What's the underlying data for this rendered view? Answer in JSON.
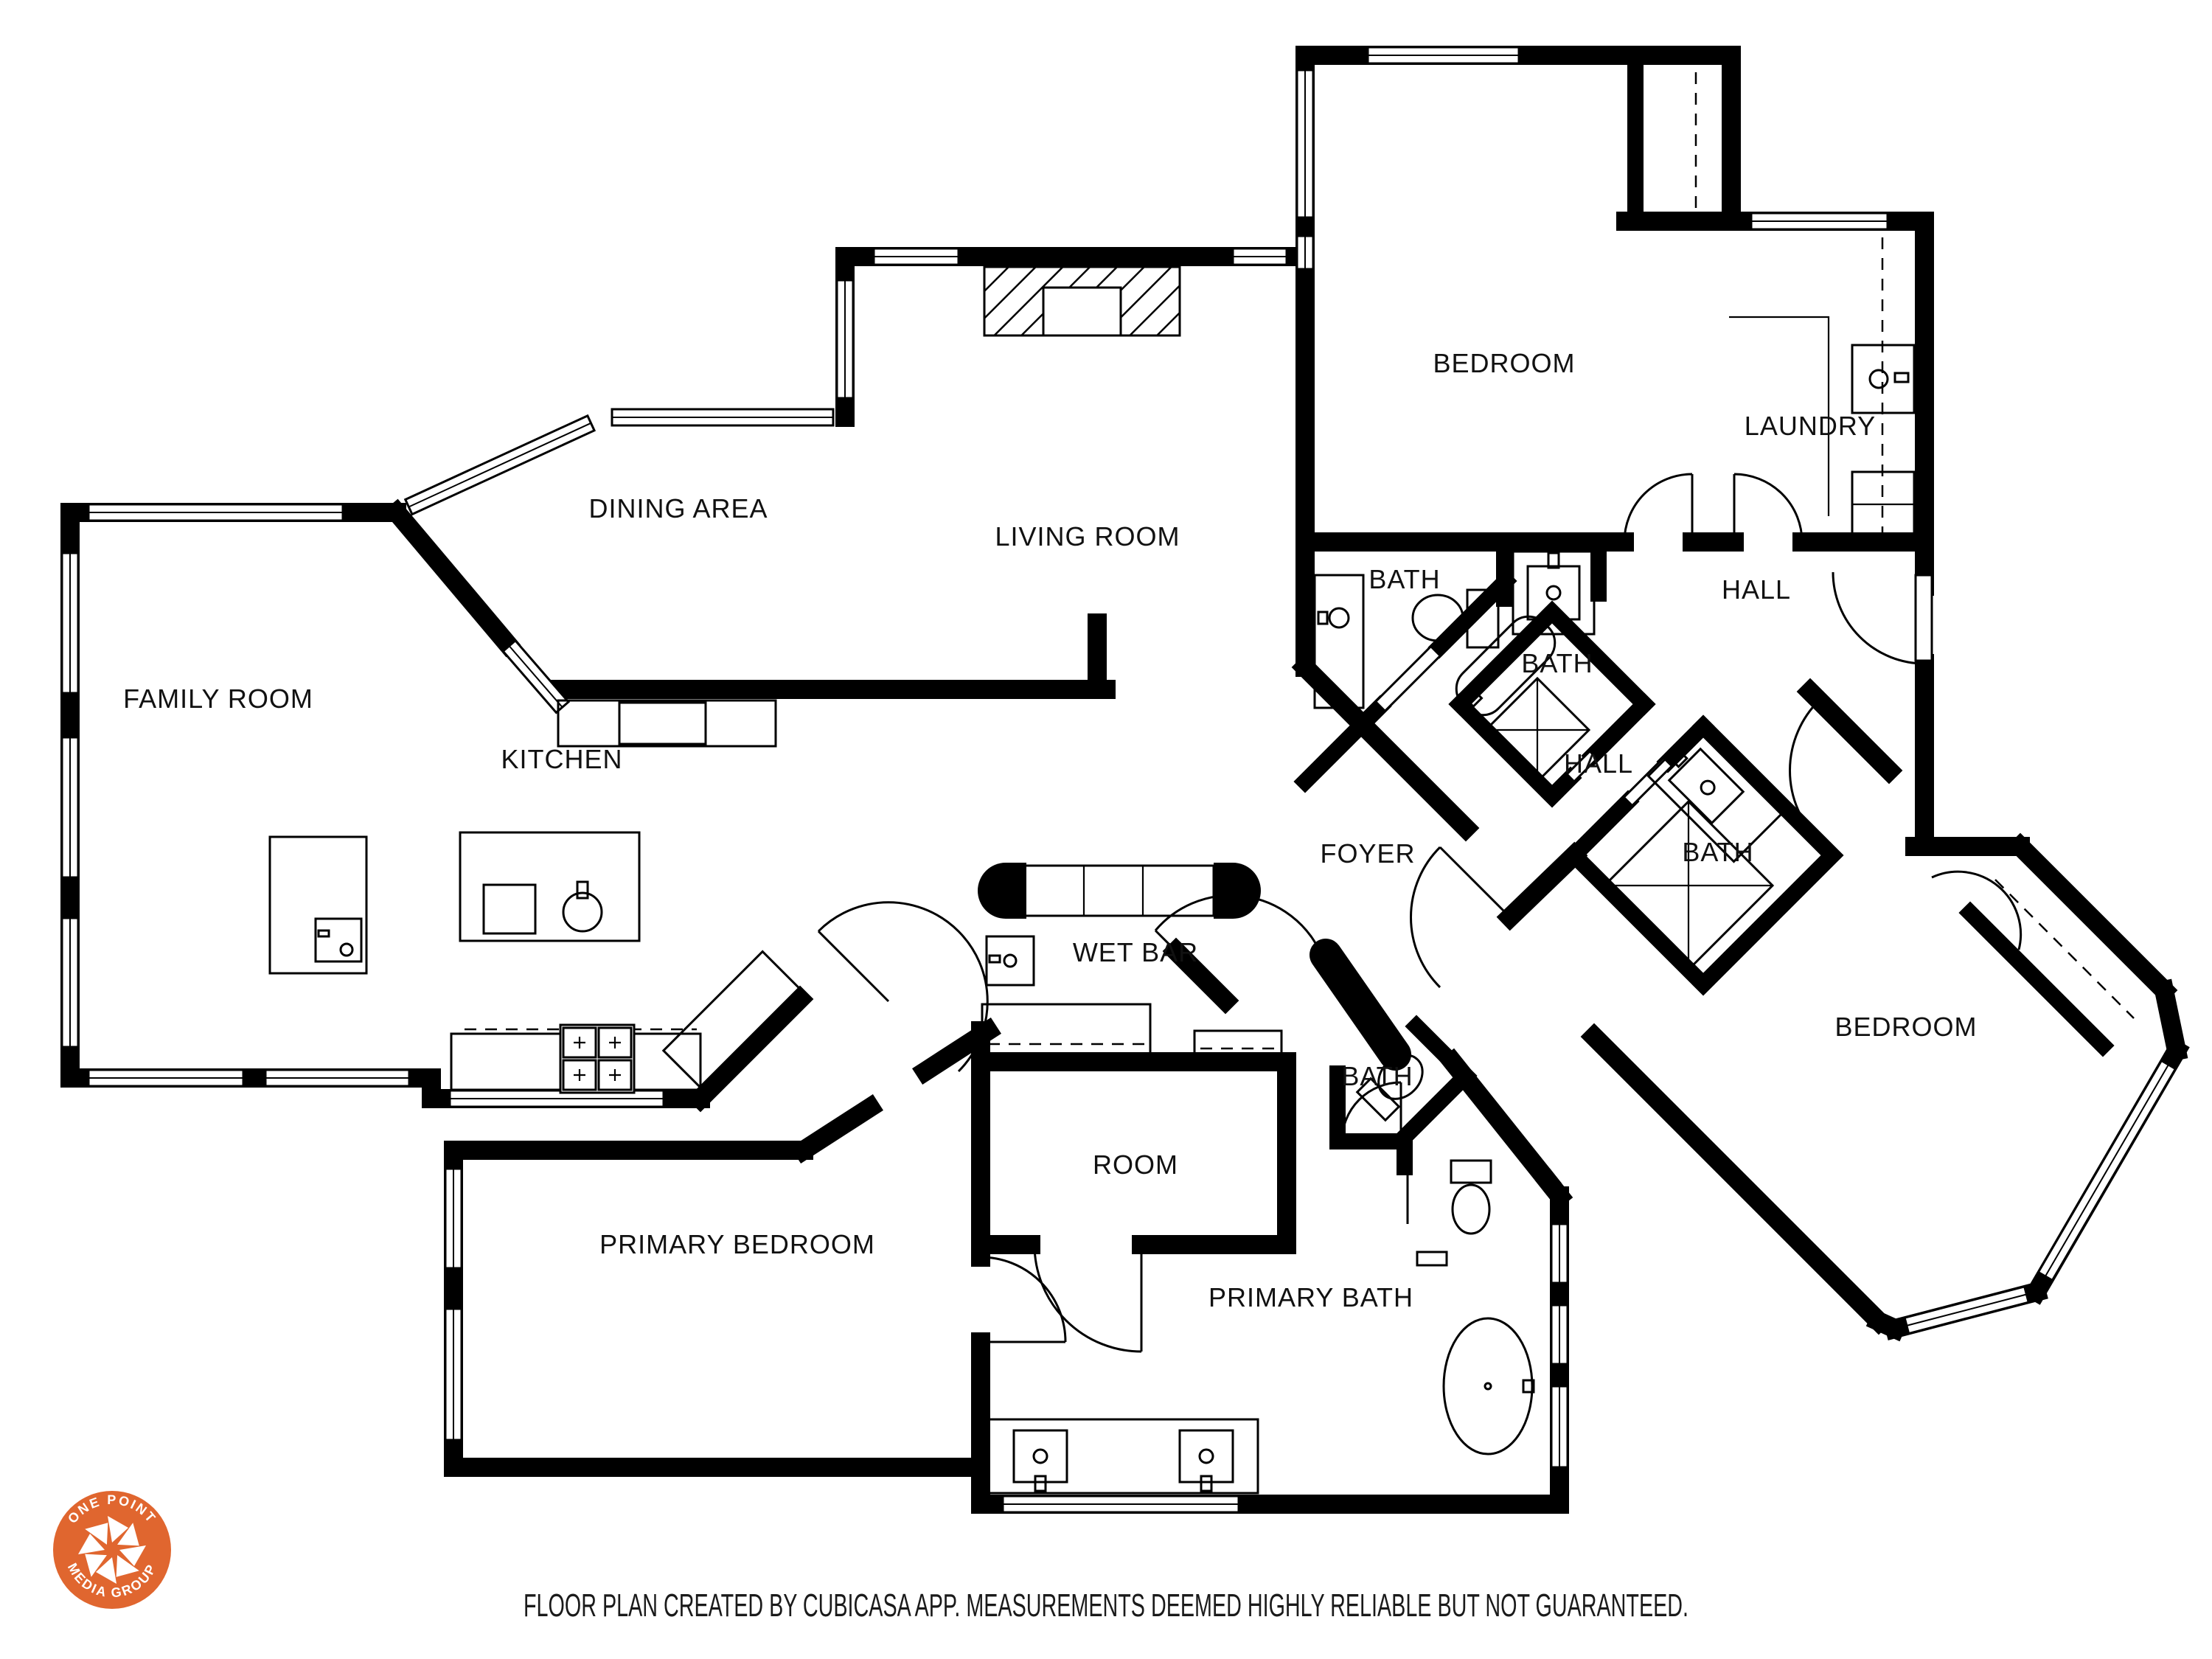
{
  "rooms": {
    "bedroom_top": "BEDROOM",
    "laundry": "LAUNDRY",
    "dining": "DINING AREA",
    "living": "LIVING ROOM",
    "family": "FAMILY ROOM",
    "kitchen": "KITCHEN",
    "bath_upper": "BATH",
    "hall_upper": "HALL",
    "bath_middle": "BATH",
    "hall_lower": "HALL",
    "foyer": "FOYER",
    "bath_right": "BATH",
    "wet_bar": "WET BAR",
    "bath_powder": "BATH",
    "bedroom_right": "BEDROOM",
    "room": "ROOM",
    "primary_bedroom": "PRIMARY BEDROOM",
    "primary_bath": "PRIMARY BATH"
  },
  "footer": {
    "disclaimer": "FLOOR PLAN CREATED BY CUBICASA APP. MEASUREMENTS DEEMED HIGHLY RELIABLE BUT NOT GUARANTEED."
  },
  "logo": {
    "arc_top": "ONE POINT",
    "arc_bottom": "MEDIA GROUP",
    "color": "#E0662F"
  }
}
